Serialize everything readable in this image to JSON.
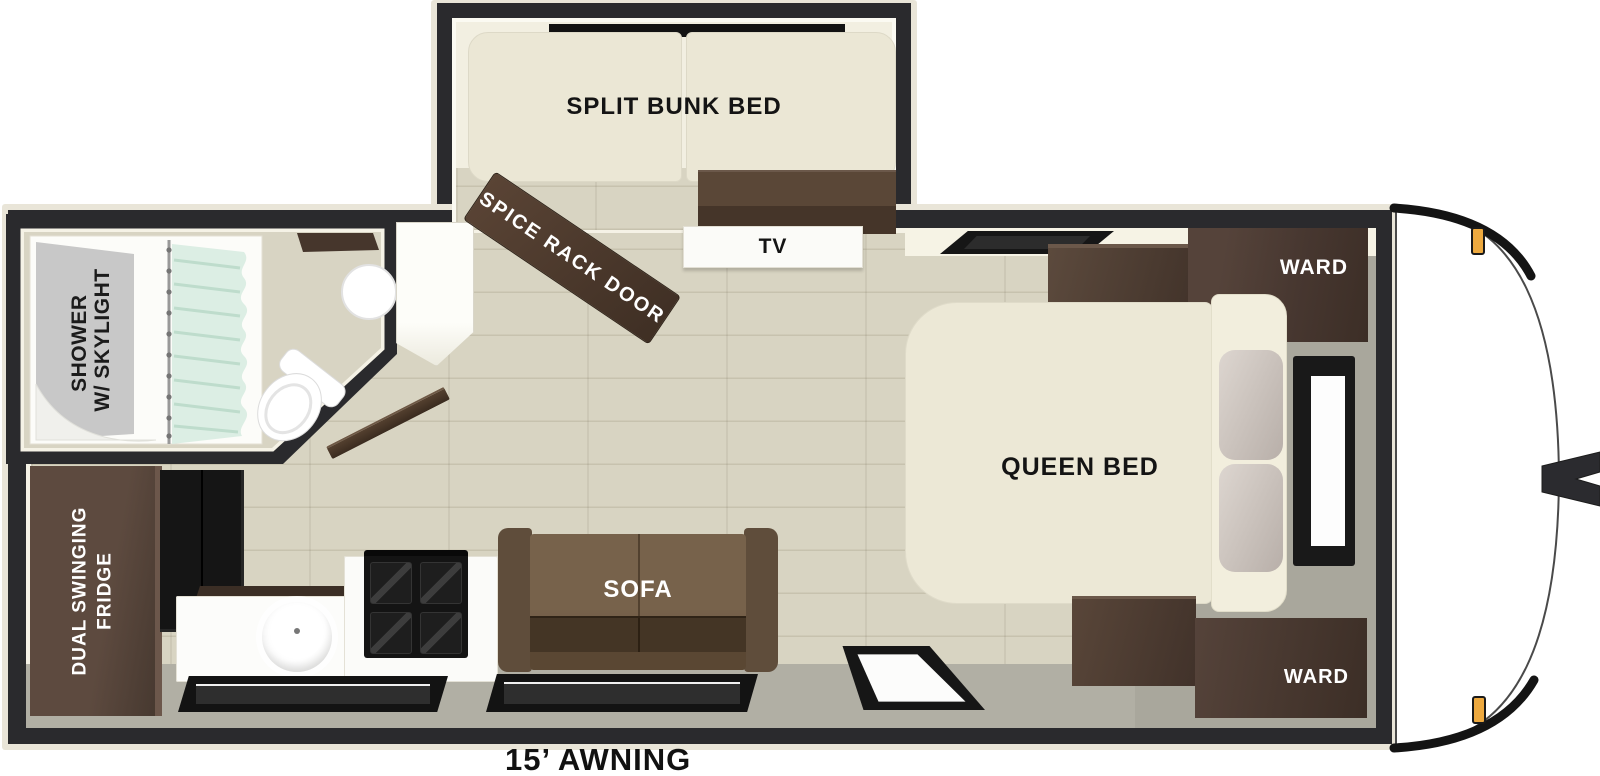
{
  "diagram": {
    "title": "travel-trailer-floorplan",
    "awning_label": "15’ AWNING",
    "labels": {
      "bunk": "SPLIT BUNK BED",
      "spice_rack_door": "SPICE RACK DOOR",
      "tv": "TV",
      "ward_top": "WARD",
      "ward_bottom": "WARD",
      "queen_bed": "QUEEN BED",
      "sofa": "SOFA",
      "shower_line1": "SHOWER",
      "shower_line2": "W/ SKYLIGHT",
      "fridge_line1": "DUAL SWINGING",
      "fridge_line2": "FRIDGE"
    },
    "colors": {
      "wall": "#2a2a2d",
      "trim": "#e9e5d8",
      "wood_floor": "#d8d4c2",
      "gray_floor": "#b1afa4",
      "bedroom_gray": "#a9a79c",
      "mattress_cream": "#ebe7d5",
      "dark_wood_cabinet": "#4a392f",
      "sofa_brown": "#6a563f",
      "curtain_mint": "#dceee4",
      "marker_amber": "#eda93f",
      "label_dark": "#141414",
      "label_light": "#ffffff"
    }
  }
}
